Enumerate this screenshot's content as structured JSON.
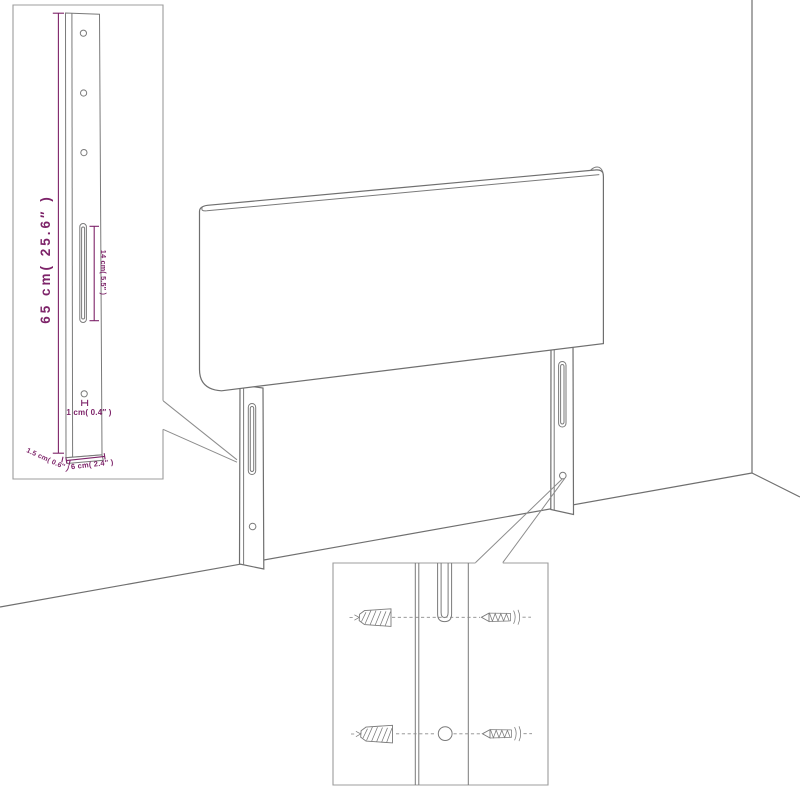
{
  "title": "Headboard dimension diagram",
  "colors": {
    "background": "#ffffff",
    "outline_gray": "#6f6f6f",
    "inset_border_gray": "#9c9c9c",
    "dimension_purple": "#7d2369"
  },
  "dimensions": {
    "leg_height": "65 cm( 25.6″ )",
    "slot_length": "14 cm( 5.5″ )",
    "hole_diameter": "1 cm( 0.4″ )",
    "leg_thickness": "1.5 cm( 0.6″ )",
    "leg_width": "6 cm( 2.4″ )"
  }
}
